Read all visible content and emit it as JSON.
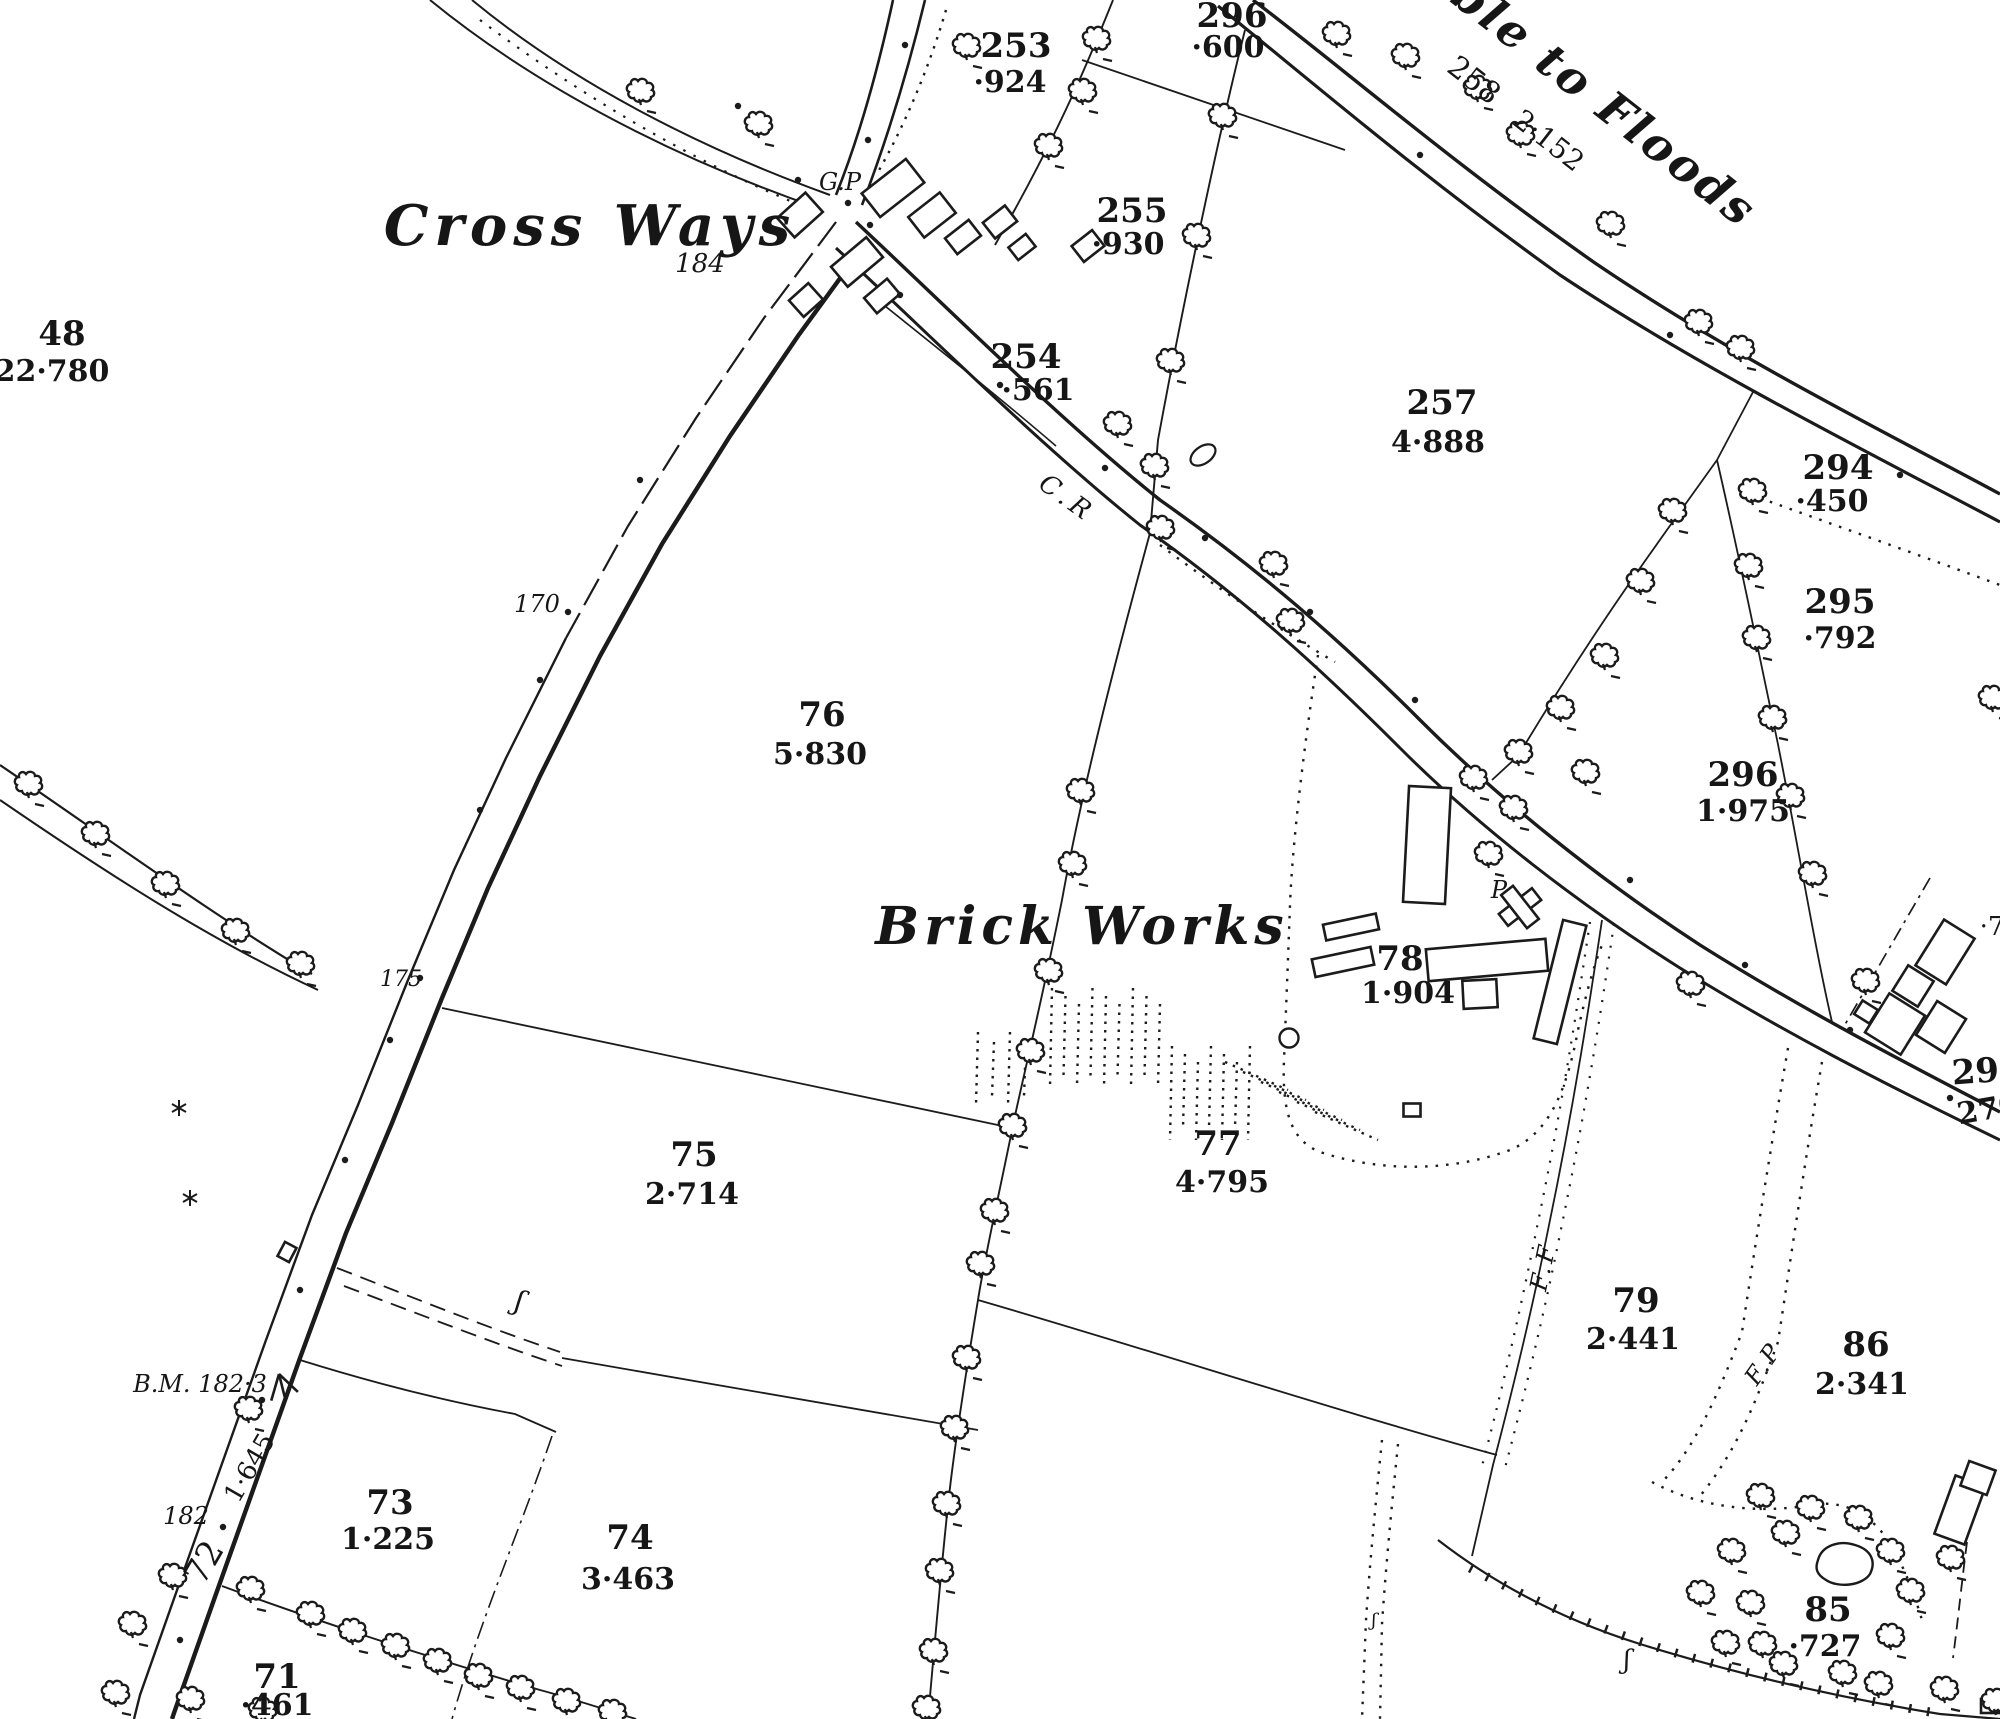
{
  "map": {
    "colors": {
      "paper": "#ffffff",
      "ink": "#1b1b1b"
    },
    "icons": {
      "tree": "hedgerow-tree-icon",
      "bush": "bush-star-icon",
      "benchmark": "broad-arrow-benchmark-icon",
      "survey_dot": "boundary-mereing-dot",
      "pond": "pond-outline"
    },
    "place_names": [
      {
        "id": "cross-ways",
        "text": "Cross Ways",
        "x": 590,
        "y": 245,
        "size": 56,
        "italic": true,
        "rot": 0,
        "ls": 6
      },
      {
        "id": "brick-works",
        "text": "Brick Works",
        "x": 1082,
        "y": 944,
        "size": 52,
        "italic": true,
        "rot": 0,
        "ls": 5
      },
      {
        "id": "liable-to-floods",
        "text": "ble to Floods",
        "x": 1595,
        "y": 115,
        "size": 46,
        "italic": true,
        "rot": 38,
        "ls": 3
      }
    ],
    "parcels": [
      {
        "n": "48",
        "nx": 62,
        "ny": 345,
        "a": "22·780",
        "ax": 52,
        "ay": 381
      },
      {
        "n": "253",
        "nx": 1016,
        "ny": 57,
        "a": "·924",
        "ax": 1010,
        "ay": 92
      },
      {
        "n": "296",
        "nx": 1232,
        "ny": 27,
        "a": "·600",
        "ax": 1228,
        "ay": 57
      },
      {
        "n": "255",
        "nx": 1132,
        "ny": 222,
        "a": "·930",
        "ax": 1128,
        "ay": 254
      },
      {
        "n": "254",
        "nx": 1026,
        "ny": 368,
        "a": "·561",
        "ax": 1038,
        "ay": 400
      },
      {
        "n": "257",
        "nx": 1442,
        "ny": 414,
        "a": "4·888",
        "ax": 1438,
        "ay": 452
      },
      {
        "n": "294",
        "nx": 1838,
        "ny": 479,
        "a": "·450",
        "ax": 1832,
        "ay": 511
      },
      {
        "n": "295",
        "nx": 1840,
        "ny": 613,
        "a": "·792",
        "ax": 1840,
        "ay": 648
      },
      {
        "n": "296",
        "nx": 1743,
        "ny": 786,
        "a": "1·975",
        "ax": 1743,
        "ay": 821
      },
      {
        "n": "76",
        "nx": 822,
        "ny": 726,
        "a": "5·830",
        "ax": 820,
        "ay": 764
      },
      {
        "n": "78",
        "nx": 1400,
        "ny": 970,
        "a": "1·904",
        "ax": 1408,
        "ay": 1003
      },
      {
        "n": "77",
        "nx": 1218,
        "ny": 1155,
        "a": "4·795",
        "ax": 1222,
        "ay": 1192
      },
      {
        "n": "75",
        "nx": 694,
        "ny": 1166,
        "a": "2·714",
        "ax": 692,
        "ay": 1204
      },
      {
        "n": "79",
        "nx": 1636,
        "ny": 1312,
        "a": "2·441",
        "ax": 1633,
        "ay": 1349
      },
      {
        "n": "86",
        "nx": 1866,
        "ny": 1356,
        "a": "2·341",
        "ax": 1862,
        "ay": 1394
      },
      {
        "n": "73",
        "nx": 390,
        "ny": 1514,
        "a": "1·225",
        "ax": 388,
        "ay": 1549
      },
      {
        "n": "74",
        "nx": 630,
        "ny": 1549,
        "a": "3·463",
        "ax": 628,
        "ay": 1589
      },
      {
        "n": "71",
        "nx": 277,
        "ny": 1688,
        "a": "·461",
        "ax": 277,
        "ay": 1715
      },
      {
        "n": "85",
        "nx": 1828,
        "ny": 1621,
        "a": "·727",
        "ax": 1825,
        "ay": 1656
      },
      {
        "n": "297",
        "nx": 1988,
        "ny": 1082,
        "nrot": -4,
        "a": "270",
        "ax": 1990,
        "ay": 1119,
        "arot": -10
      }
    ],
    "annotations": [
      {
        "id": "road-parcel-258",
        "text": "258",
        "x": 1468,
        "y": 88,
        "size": 30,
        "italic": false,
        "rot": 38
      },
      {
        "id": "road-area-2152",
        "text": "2·152",
        "x": 1543,
        "y": 148,
        "size": 28,
        "italic": false,
        "rot": 38
      },
      {
        "id": "cr-abbrev",
        "text": "C.R",
        "x": 1062,
        "y": 505,
        "size": 26,
        "italic": true,
        "rot": 36,
        "ls": 5
      },
      {
        "id": "guide-post",
        "text": "G.P",
        "x": 840,
        "y": 190,
        "size": 24,
        "italic": true,
        "rot": 0
      },
      {
        "id": "altitude-184",
        "text": "184",
        "x": 700,
        "y": 272,
        "size": 26,
        "italic": true,
        "rot": 0
      },
      {
        "id": "altitude-170",
        "text": "170",
        "x": 537,
        "y": 612,
        "size": 24,
        "italic": true,
        "rot": 0
      },
      {
        "id": "altitude-175",
        "text": "175",
        "x": 401,
        "y": 986,
        "size": 22,
        "italic": true,
        "rot": 0
      },
      {
        "id": "pump",
        "text": "P",
        "x": 1499,
        "y": 898,
        "size": 24,
        "italic": true,
        "rot": 0
      },
      {
        "id": "ff-abbrev",
        "text": "F.F",
        "x": 1551,
        "y": 1268,
        "size": 24,
        "italic": true,
        "rot": -78,
        "ls": 4
      },
      {
        "id": "fp-abbrev",
        "text": "F.P",
        "x": 1770,
        "y": 1368,
        "size": 24,
        "italic": true,
        "rot": -55,
        "ls": 3
      },
      {
        "id": "bench-mark-value",
        "text": "B.M. 182·3",
        "x": 200,
        "y": 1392,
        "size": 24,
        "italic": true,
        "rot": 0
      },
      {
        "id": "road-area-1645",
        "text": "1·645",
        "x": 257,
        "y": 1472,
        "size": 26,
        "italic": false,
        "rot": -60
      },
      {
        "id": "altitude-182",
        "text": "182",
        "x": 186,
        "y": 1524,
        "size": 24,
        "italic": true,
        "rot": 0
      },
      {
        "id": "road-parcel-72",
        "text": "72",
        "x": 214,
        "y": 1568,
        "size": 34,
        "italic": false,
        "rot": -60
      },
      {
        "id": "edge-fragment-7",
        "text": "·7",
        "x": 1992,
        "y": 935,
        "size": 26,
        "italic": false,
        "rot": 0
      },
      {
        "id": "brace-mark-1",
        "text": "ʃ",
        "x": 517,
        "y": 1310,
        "size": 28,
        "italic": true,
        "rot": 15
      },
      {
        "id": "brace-mark-2",
        "text": "ʃ",
        "x": 1627,
        "y": 1668,
        "size": 26,
        "italic": true,
        "rot": 0
      },
      {
        "id": "brace-mark-3",
        "text": "ʃ",
        "x": 1374,
        "y": 1626,
        "size": 18,
        "italic": true,
        "rot": 0
      }
    ]
  }
}
